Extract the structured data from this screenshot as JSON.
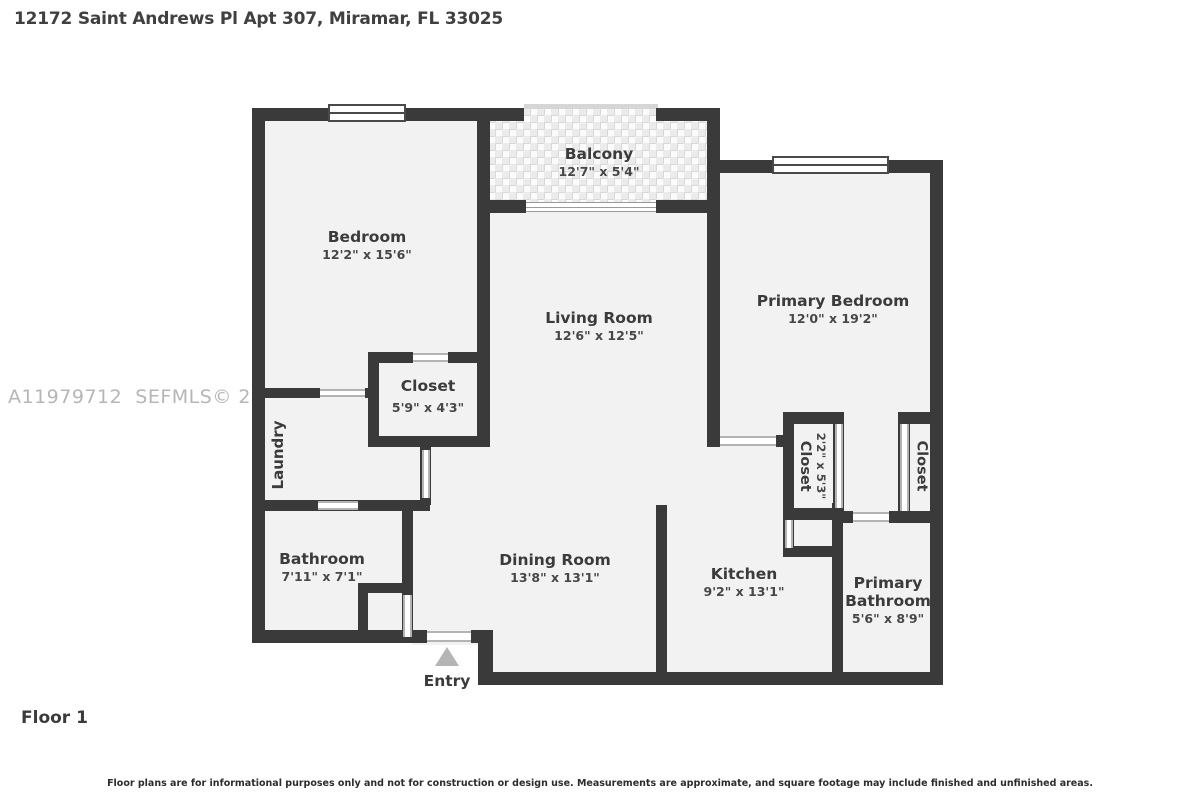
{
  "header": {
    "title": "12172 Saint Andrews Pl Apt 307, Miramar, FL 33025"
  },
  "watermark": {
    "text": "A11979712  SEFMLS© 2026"
  },
  "floor_label": "Floor 1",
  "disclaimer": "Floor plans are for informational purposes only and not for construction or design use. Measurements are approximate, and square footage may include finished and unfinished areas.",
  "colors": {
    "wall": "#3a3a3a",
    "room_fill": "#f2f2f2",
    "text": "#3b3b3b",
    "entry_arrow": "#b5b5b5",
    "watermark": "#b6b6b6"
  },
  "rooms": {
    "bedroom": {
      "name": "Bedroom",
      "dims": "12'2\" x 15'6\""
    },
    "balcony": {
      "name": "Balcony",
      "dims": "12'7\" x 5'4\""
    },
    "living_room": {
      "name": "Living Room",
      "dims": "12'6\" x 12'5\""
    },
    "primary_bedroom": {
      "name": "Primary Bedroom",
      "dims": "12'0\" x 19'2\""
    },
    "closet": {
      "name": "Closet",
      "dims": "5'9\" x 4'3\""
    },
    "laundry": {
      "name": "Laundry"
    },
    "bathroom": {
      "name": "Bathroom",
      "dims": "7'11\" x 7'1\""
    },
    "dining_room": {
      "name": "Dining Room",
      "dims": "13'8\" x 13'1\""
    },
    "kitchen": {
      "name": "Kitchen",
      "dims": "9'2\" x 13'1\""
    },
    "closet_primary_left": {
      "name": "Closet",
      "dims": "2'2\" x 5'3\""
    },
    "closet_primary_right": {
      "name": "Closet"
    },
    "primary_bathroom": {
      "name": "Primary Bathroom",
      "dims": "5'6\" x 8'9\""
    },
    "entry": {
      "name": "Entry"
    }
  }
}
